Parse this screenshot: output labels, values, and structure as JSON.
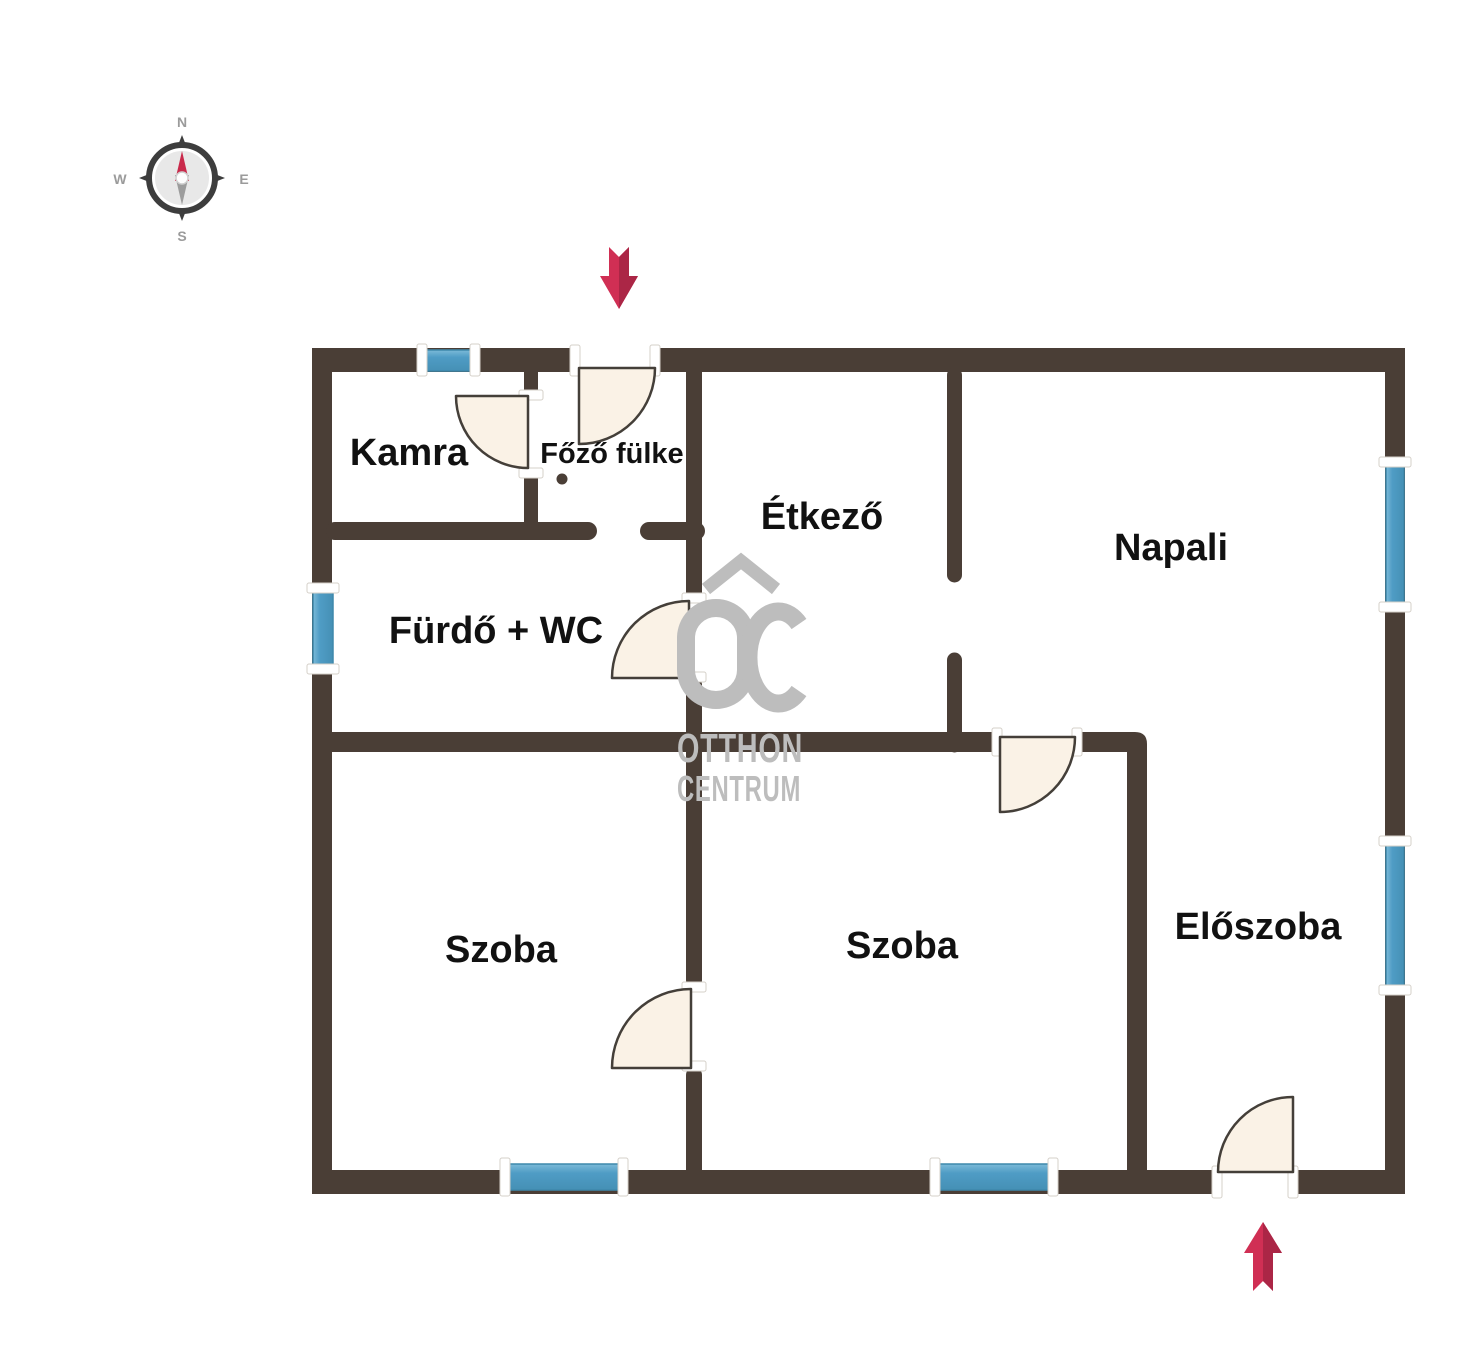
{
  "plan": {
    "rooms": {
      "kamra": {
        "label": "Kamra"
      },
      "fozo_fulke": {
        "label": "Főző fülke"
      },
      "etkezo": {
        "label": "Étkező"
      },
      "napali": {
        "label": "Napali"
      },
      "furdo_wc": {
        "label": "Fürdő + WC"
      },
      "szoba_left": {
        "label": "Szoba"
      },
      "szoba_middle": {
        "label": "Szoba"
      },
      "eloszoba": {
        "label": "Előszoba"
      }
    }
  },
  "compass": {
    "north": "N",
    "east": "E",
    "south": "S",
    "west": "W"
  },
  "watermark": {
    "logo": "OC",
    "line1": "OTTHON",
    "line2": "CENTRUM"
  },
  "colors": {
    "background": "#ffffff",
    "wall": "#4a3e36",
    "window_fill": "#4f9cc5",
    "window_light": "#7cbad8",
    "window_stroke": "#3e88ac",
    "door_fill": "#faf2e6",
    "door_stroke": "#443f39",
    "jamb_fill": "#ffffff",
    "jamb_stroke": "#d5d0c9",
    "arrow_red": "#d02f54",
    "arrow_dark": "#ab2646",
    "watermark_gray": "#bdbdbd",
    "label_color": "#111111",
    "compass_dark": "#3d3d3d",
    "compass_gray": "#9b9b9b",
    "needle_red": "#c92a4b",
    "needle_gray": "#9c9c9c"
  }
}
